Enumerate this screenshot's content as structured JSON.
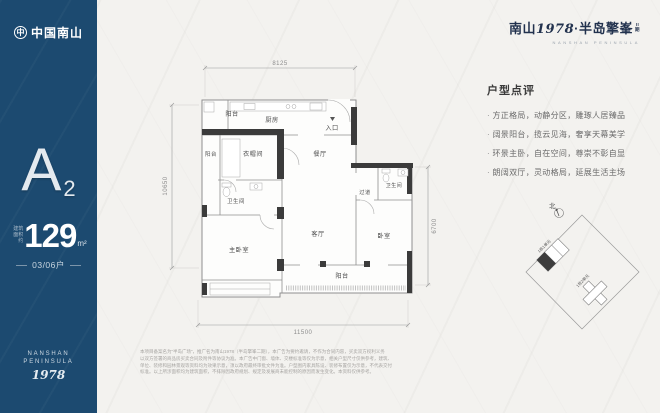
{
  "colors": {
    "sidebar_bg": "#1c4a70",
    "paper": "#f3f2ef",
    "ink": "#22324e",
    "wall_dark": "#3b3b3b",
    "wall_gray": "#8f8f8f"
  },
  "sidebar": {
    "logo_glyph": "中",
    "logo_text": "中国南山",
    "unit_letter": "A",
    "unit_number": "2",
    "area_prefix": "建筑面积约",
    "area_value": "129",
    "area_unit": "m²",
    "household": "03/06户",
    "brand_en1": "NANSHAN",
    "brand_en2": "PENINSULA",
    "brand_year": "1978"
  },
  "header": {
    "brand": "南山",
    "year": "1978",
    "name": "·半岛擎峯",
    "phase_line1": "II",
    "phase_line2": "期",
    "subtitle": "NANSHAN PENINSULA"
  },
  "review": {
    "title": "户型点评",
    "items": [
      "方正格局，动静分区，雕琢人居臻品",
      "阔景阳台，揽云见海，奢享天幕美学",
      "环景主卧，自在空间，尊崇不彰自显",
      "朗阔双厅，灵动格局，延展生活主场"
    ]
  },
  "plan": {
    "rooms": {
      "balcony_top": "阳台",
      "kitchen": "厨房",
      "entrance": "入口",
      "balcony_left": "阳台",
      "cloakroom": "衣帽间",
      "dining": "餐厅",
      "bath_left": "卫生间",
      "master": "主卧室",
      "living": "客厅",
      "corridor": "过道",
      "bath_right": "卫生间",
      "bedroom": "卧室",
      "balcony_bottom": "阳台"
    },
    "dims": {
      "top": "8125",
      "left": "10650",
      "right": "6700",
      "bottom": "11500"
    }
  },
  "site": {
    "compass": "北",
    "building1": "1栋1单元",
    "building2": "1栋2单元"
  },
  "disclaimer": {
    "lines": [
      "本项目备案名为“半岛广场”，推广名为南山1978（半岛擎峯二期），本广告为要约邀请，不作为合同内容，买卖双方权利义务",
      "以双方签署的商品房买卖合同及附件等协议为准。本广告中门窗、墙体、交楼标准等仅为示意，相关户型尺寸仅供参考，建筑、",
      "单位、装修和园林景观等资料均为效果示意，须以政府最终审批文件为准。户型图内家具陈设、装修布置仅为示意，不代表交付",
      "标准。以上所涉面积均为建筑面积，不排除因政府规划、规定及发展商未能控制的原因而发生变化。本资料仅供参考。"
    ]
  }
}
